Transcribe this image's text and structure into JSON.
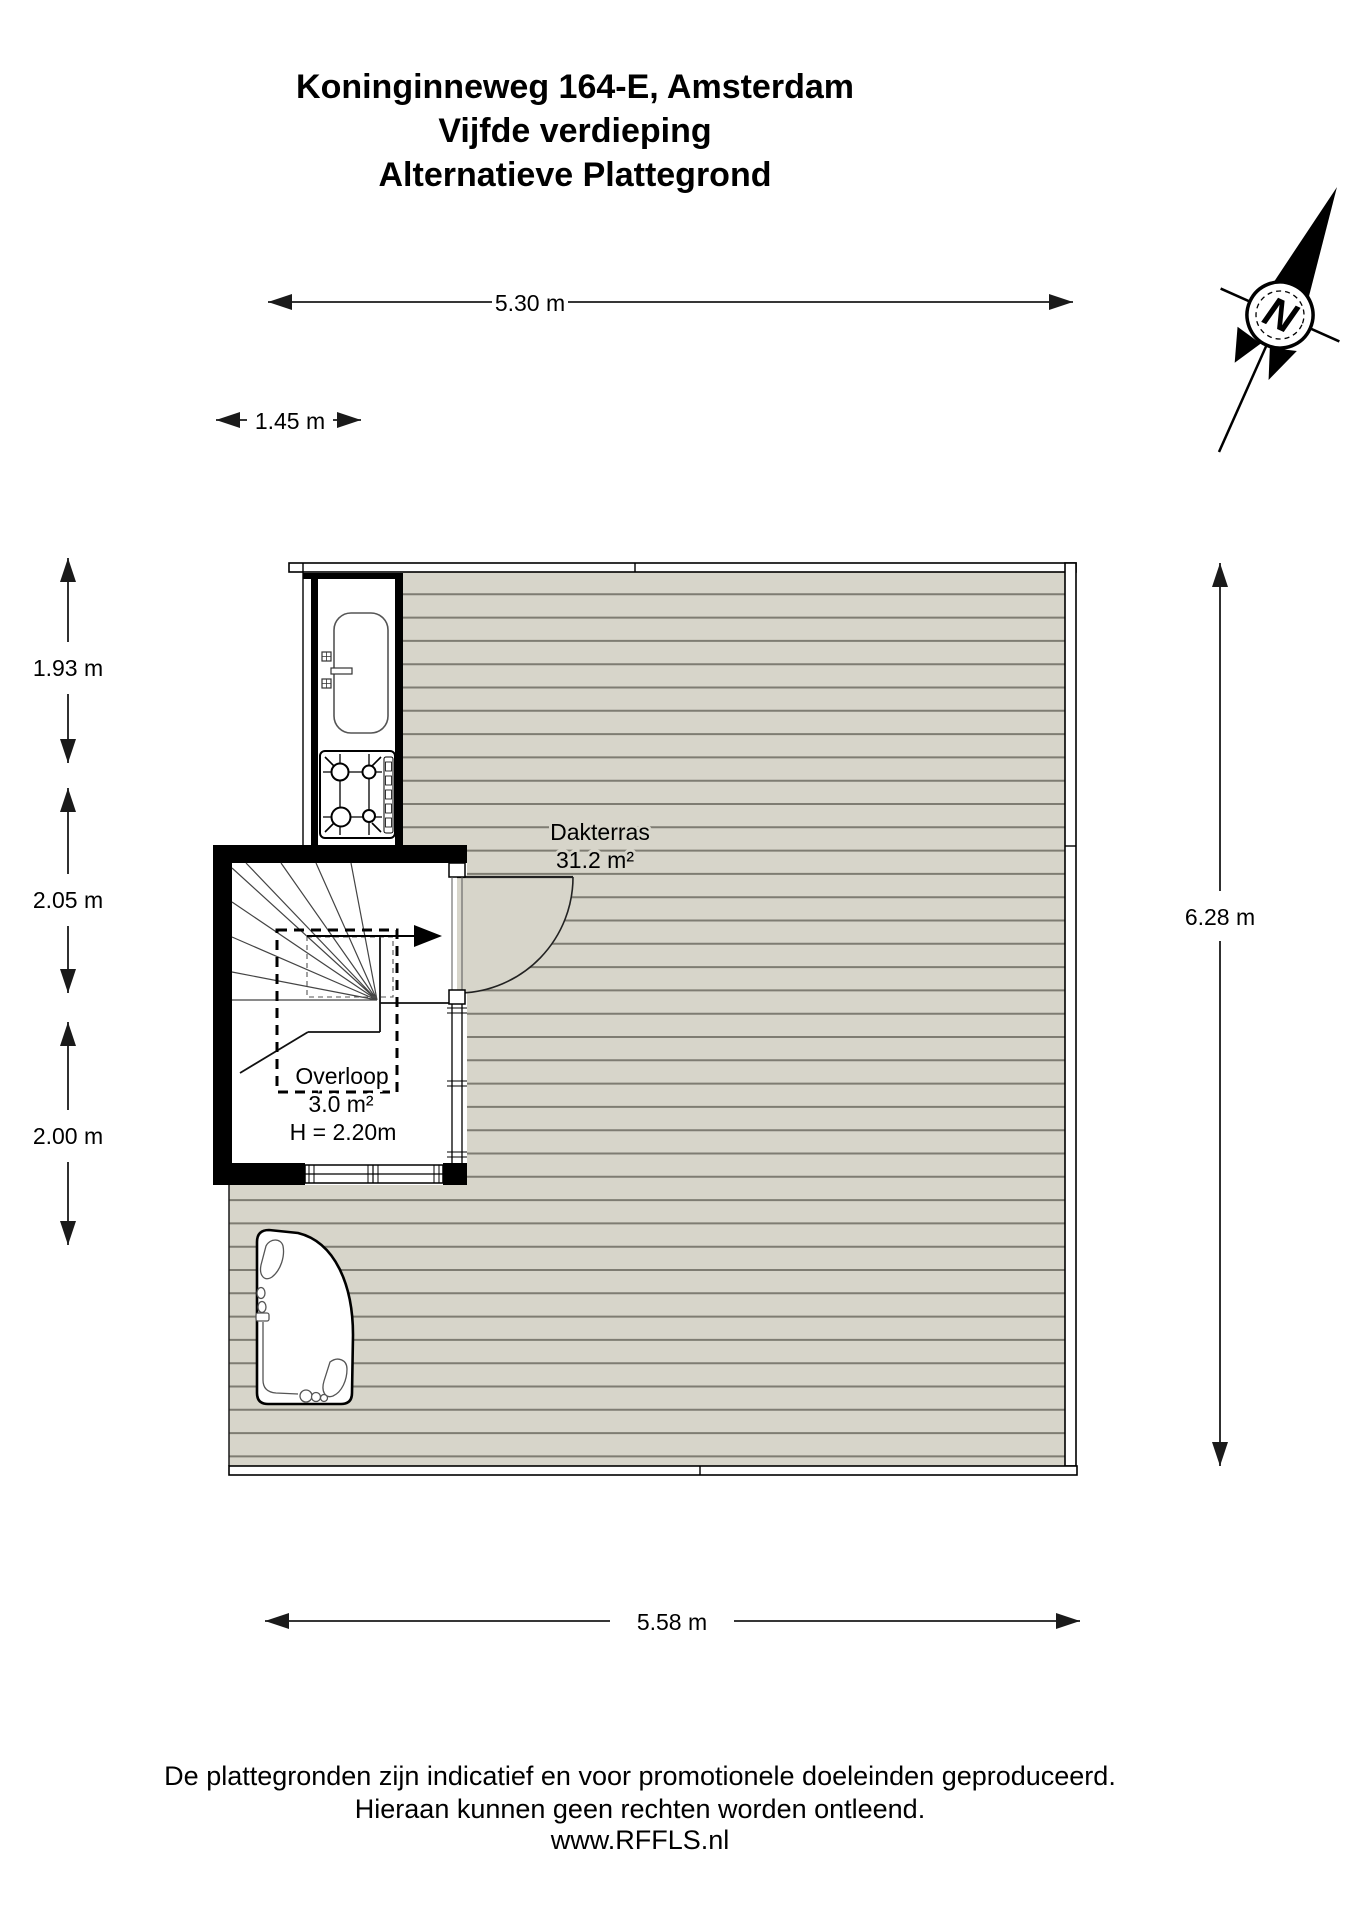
{
  "title": {
    "line1": "Koninginneweg 164-E, Amsterdam",
    "line2": "Vijfde verdieping",
    "line3": "Alternatieve Plattegrond"
  },
  "compass": {
    "north_label": "N"
  },
  "dimensions": {
    "top_width": "5.30 m",
    "stair_block_width": "1.45 m",
    "left_top": "1.93 m",
    "left_middle": "2.05 m",
    "left_bottom": "2.00 m",
    "right_height": "6.28 m",
    "bottom_width": "5.58 m"
  },
  "rooms": {
    "terrace": {
      "name": "Dakterras",
      "area": "31.2 m²"
    },
    "landing": {
      "name": "Overloop",
      "area": "3.0 m²",
      "ceiling_height": "H = 2.20m"
    }
  },
  "footer": {
    "line1": "De plattegronden zijn indicatief en voor promotionele doeleinden geproduceerd.",
    "line2": "Hieraan kunnen geen rechten worden ontleend.",
    "line3": "www.RFFLS.nl"
  },
  "colors": {
    "background": "#ffffff",
    "deck_fill": "#d7d5ca",
    "deck_line": "#7e7c72",
    "wall": "#000000"
  }
}
